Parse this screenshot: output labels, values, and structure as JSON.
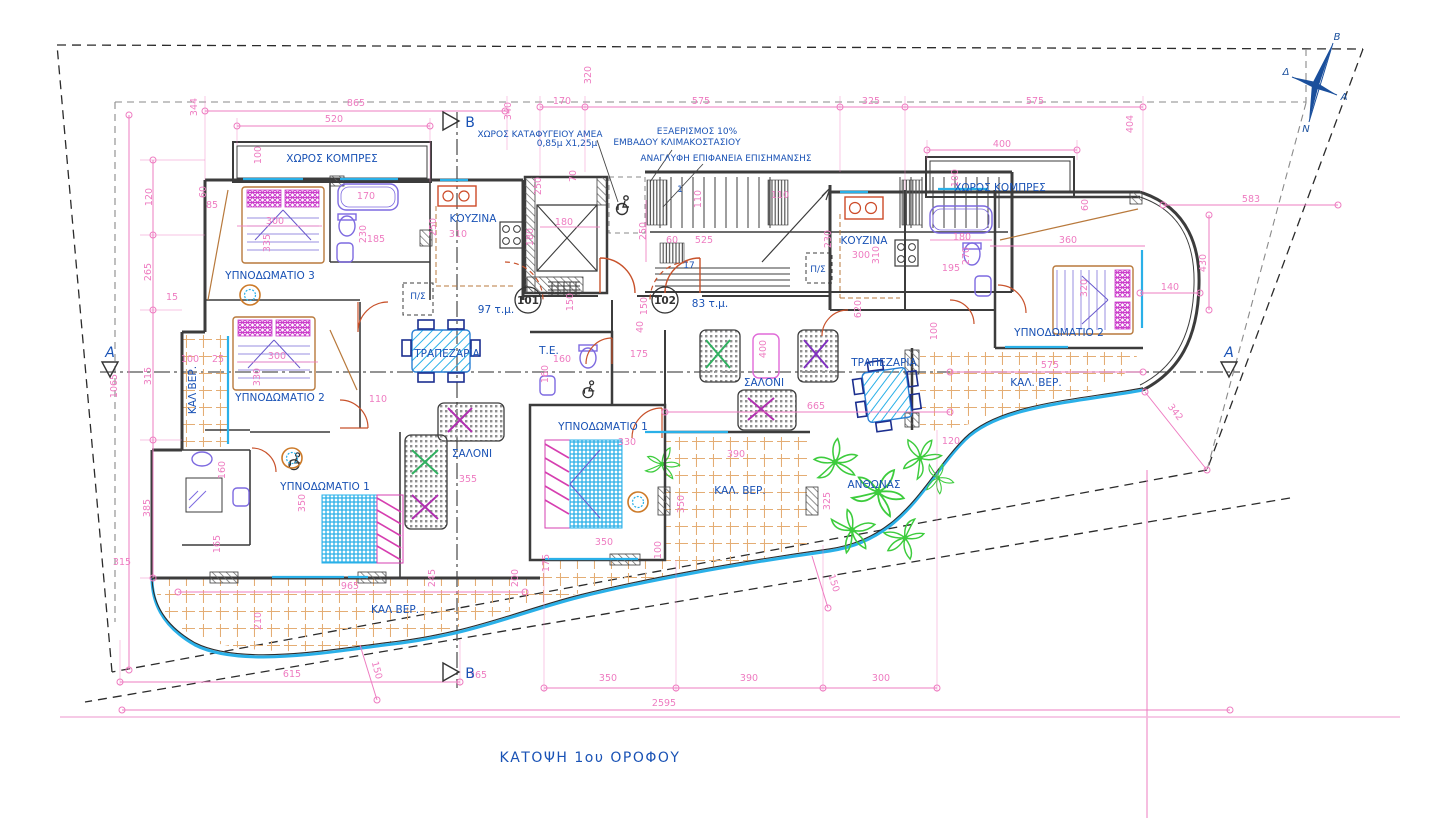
{
  "title": "ΚΑΤΟΨΗ 1ου ΟΡΟΦΟΥ",
  "apartments": {
    "a101": {
      "number": "101",
      "area": "97 τ.μ."
    },
    "a102": {
      "number": "102",
      "area": "83 τ.μ."
    }
  },
  "notes": {
    "refuge1": "ΧΩΡΟΣ ΚΑΤΑΦΥΓΕΙΟΥ ΑΜΕΑ",
    "refuge2": "0,85μ Χ1,25μ",
    "vent1": "ΕΞΑΕΡΙΣΜΟΣ 10%",
    "vent2": "ΕΜΒΑΔΟΥ ΚΛΙΜΑΚΟΣΤΑΣΙΟΥ",
    "tactile": "ΑΝΑΓΛΥΦΗ ΕΠΙΦΑΝΕΙΑ ΕΠΙΣΗΜΑΝΣΗΣ"
  },
  "rooms": {
    "compres_left": "ΧΩΡΟΣ ΚΟΜΠΡΕΣ",
    "compres_right": "ΧΩΡΟΣ ΚΟΜΠΡΕΣ",
    "bedroom3_a": "ΥΠΝΟΔΩΜΑΤΙΟ 3",
    "bedroom2_a": "ΥΠΝΟΔΩΜΑΤΙΟ 2",
    "bedroom1_a": "ΥΠΝΟΔΩΜΑΤΙΟ 1",
    "kitchen_a": "ΚΟΥΖΙΝΑ",
    "dining_a": "ΤΡΑΠΕΖΑΡΙΑ",
    "living_a": "ΣΑΛΟΝΙ",
    "closet_a": "Π/Σ",
    "wc_b": "Τ.Ε.",
    "closet_b": "Π/Σ",
    "bedroom1_b": "ΥΠΝΟΔΩΜΑΤΙΟ 1",
    "bedroom2_b": "ΥΠΝΟΔΩΜΑΤΙΟ 2",
    "kitchen_b": "ΚΟΥΖΙΝΑ",
    "dining_b": "ΤΡΑΠΕΖΑΡΙΑ",
    "living_b": "ΣΑΛΟΝΙ",
    "veranda_left": "ΚΑΛ ΒΕΡ.",
    "veranda_bottom": "ΚΑΛ ΒΕΡ.",
    "veranda_mid": "ΚΑΛ. ΒΕΡ.",
    "veranda_right": "ΚΑΛ. ΒΕΡ.",
    "planter": "ΑΝΘΩΝΑΣ"
  },
  "markers": {
    "section_a": "A",
    "section_b": "B",
    "stair_first": "1",
    "stair_last": "17"
  },
  "compass": {
    "north": "Β",
    "south": "Ν",
    "east": "Α",
    "west": "Δ"
  },
  "dims": [
    "865",
    "520",
    "344",
    "340",
    "170",
    "320",
    "575",
    "325",
    "575",
    "404",
    "400",
    "100",
    "583",
    "430",
    "360",
    "140",
    "320",
    "180",
    "270",
    "195",
    "230",
    "300",
    "310",
    "620",
    "100",
    "100",
    "120",
    "265",
    "15",
    "315",
    "1065",
    "385",
    "315",
    "160",
    "165",
    "350",
    "110",
    "355",
    "100",
    "25",
    "300",
    "335",
    "300",
    "330",
    "170",
    "230",
    "185",
    "85",
    "60",
    "250",
    "310",
    "180",
    "180",
    "250",
    "70",
    "110",
    "110",
    "525",
    "60",
    "250",
    "150",
    "150",
    "160",
    "160",
    "175",
    "40",
    "330",
    "350",
    "350",
    "390",
    "400",
    "665",
    "120",
    "325",
    "100",
    "150",
    "342",
    "575",
    "210",
    "615",
    "150",
    "365",
    "965",
    "245",
    "200",
    "175",
    "350",
    "390",
    "300",
    "2595",
    "60"
  ],
  "colors": {
    "dimension": "#ee7cc1",
    "label_blue": "#1952b5",
    "wall": "#3c3c3c",
    "window_cyan": "#2ab0e8",
    "tile_tan": "#e4ad74",
    "door_orange": "#c8522b",
    "fixture_purple": "#7d6ae0",
    "plant_green": "#3dcc3d",
    "compass_navy": "#1a4f9c"
  }
}
